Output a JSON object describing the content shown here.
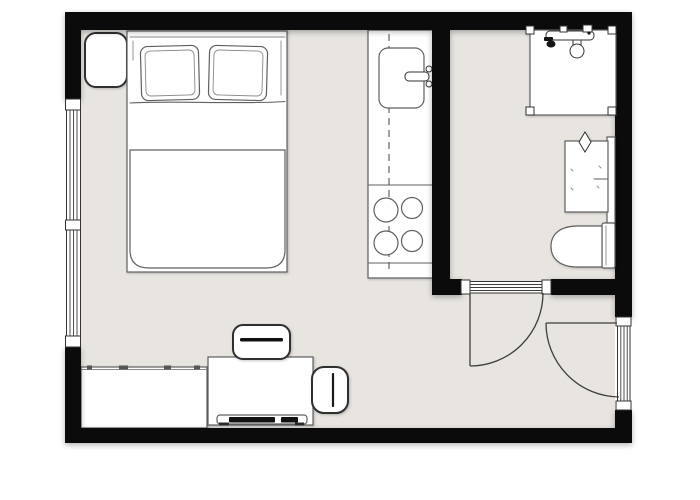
{
  "meta": {
    "label": "Studio apartment floor plan",
    "type": "floor-plan"
  },
  "colors": {
    "canvas": "#ffffff",
    "floor": "#e8e5e1",
    "wall": "#0b0b0b",
    "line_soft": "#5f5f5f",
    "line_bold": "#2f2f2f",
    "ink": "#111111",
    "fixture": "#ffffff"
  },
  "rooms": [
    {
      "name": "main-room",
      "features": [
        "double-bed",
        "nightstand",
        "kitchenette",
        "sideboard",
        "desk",
        "desk-chair",
        "armchair"
      ]
    },
    {
      "name": "bathroom",
      "features": [
        "shower",
        "vanity-sink",
        "toilet"
      ]
    }
  ],
  "openings": {
    "windows": [
      "left-wall-double-window"
    ],
    "doors": [
      "bathroom-door",
      "entry-door"
    ]
  },
  "kitchen": {
    "burner_count": 4
  }
}
